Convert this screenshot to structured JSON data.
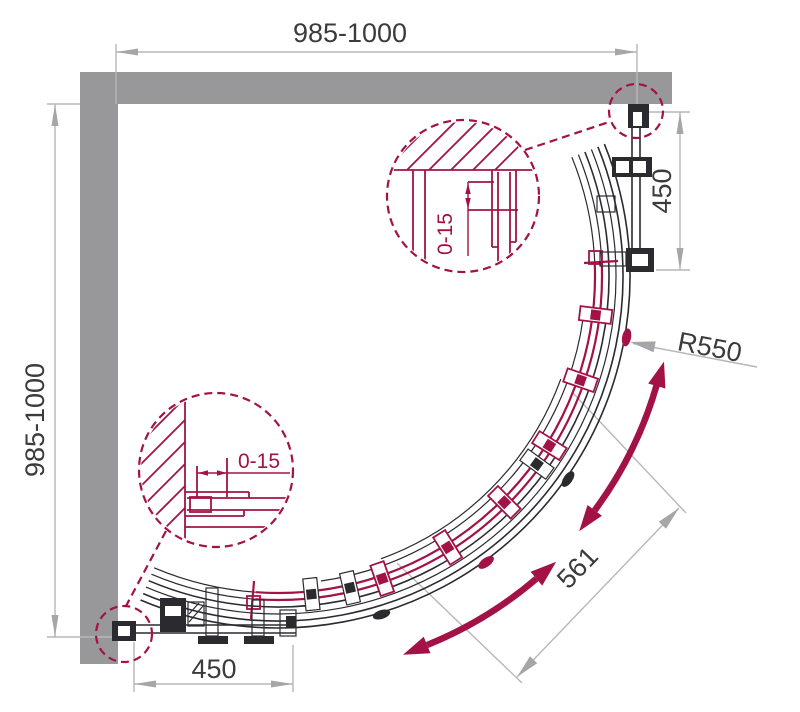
{
  "title": "Quadrant shower enclosure - plan view technical drawing",
  "dimensions": {
    "overall_width": "985-1000",
    "overall_depth": "985-1000",
    "side_panel_right": "450",
    "side_panel_bottom": "450",
    "door_radius": "R550",
    "opening_width": "561",
    "wall_profile_adjustment_top": "0-15",
    "wall_profile_adjustment_bottom": "0-15"
  },
  "colors": {
    "wall_gray": "#98989a",
    "drawing_black": "#2b2b2f",
    "accent_red": "#a31246",
    "dimension_gray": "#b6b7b9",
    "arrow_gray": "#a5a6a8",
    "text_dark": "#3b3b3d"
  }
}
